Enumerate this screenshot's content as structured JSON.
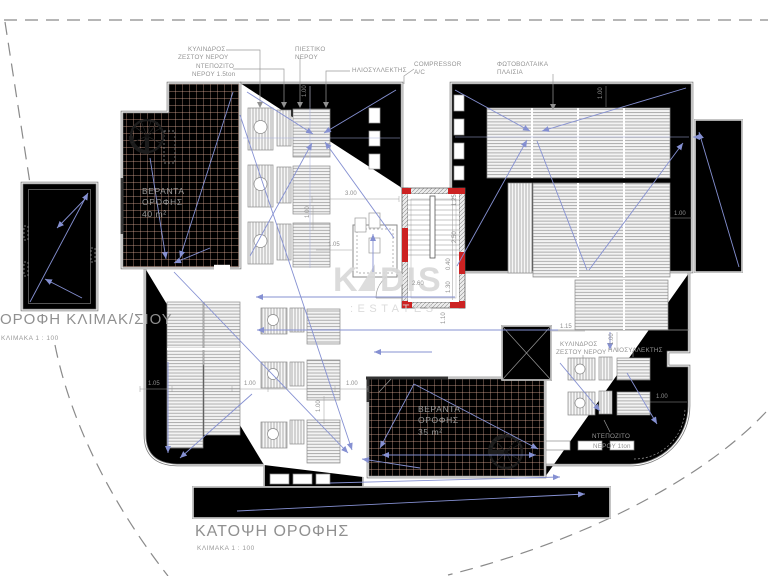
{
  "titles": {
    "left_plan": "ΟΡΟΦΗ ΚΛΙΜΑΚ/ΣΙΟΥ",
    "left_scale": "ΚΛΙΜΑΚΑ 1 : 100",
    "main_plan": "ΚΑΤΟΨΗ ΟΡΟΦΗΣ",
    "main_scale": "ΚΛΙΜΑΚΑ 1 : 100"
  },
  "watermark": {
    "k": "K",
    "dis": "DIS",
    "estates": ":ESTATES"
  },
  "verandas": {
    "v40_1": "ΒΕΡΑΝΤΑ",
    "v40_2": "ΟΡΟΦΗΣ",
    "v40_area": "40 m²",
    "v35_1": "ΒΕΡΑΝΤΑ",
    "v35_2": "ΟΡΟΦΗΣ",
    "v35_area": "35 m²"
  },
  "labels": {
    "cyl1": "ΚΥΛΙΝΔΡΟΣ",
    "cyl2": "ΖΕΣΤΟΥ ΝΕΡΟΥ",
    "dep1": "ΝΤΕΠΟΖΙΤΟ",
    "dep2": "ΝΕΡΟΥ 1.5ton",
    "pies1": "ΠΙΕΣΤΙΚΟ",
    "pies2": "ΝΕΡΟΥ",
    "solar": "ΗΛΙΟΣΥΛΛΕΚΤΗΣ",
    "comp1": "COMPRESSOR",
    "comp2": "A/C",
    "pv1": "ΦΩΤΟΒΟΛΤΑΙΚΑ",
    "pv2": "ΠΛΑΙΣΙΑ",
    "dep1t1": "ΝΤΕΠΟΖΙΤΟ",
    "dep1t2": "ΝΕΡΟΥ 1ton"
  },
  "dims": {
    "d040": "0.40",
    "d100": "1.00",
    "d105": "1.05",
    "d110": "1.10",
    "d115": "1.15",
    "d125": "1.25",
    "d130": "1.30",
    "d250": "2.50",
    "d260": "2.60",
    "d300": "3.00"
  },
  "colors": {
    "arrow_blue": "#8590d2",
    "hatch_orange": "#e3b09c",
    "wall_red": "#cc2222",
    "line_gray": "#7a7a7a",
    "text_gray": "#8e8e8e",
    "watermark_gray": "#d8d8d8"
  }
}
